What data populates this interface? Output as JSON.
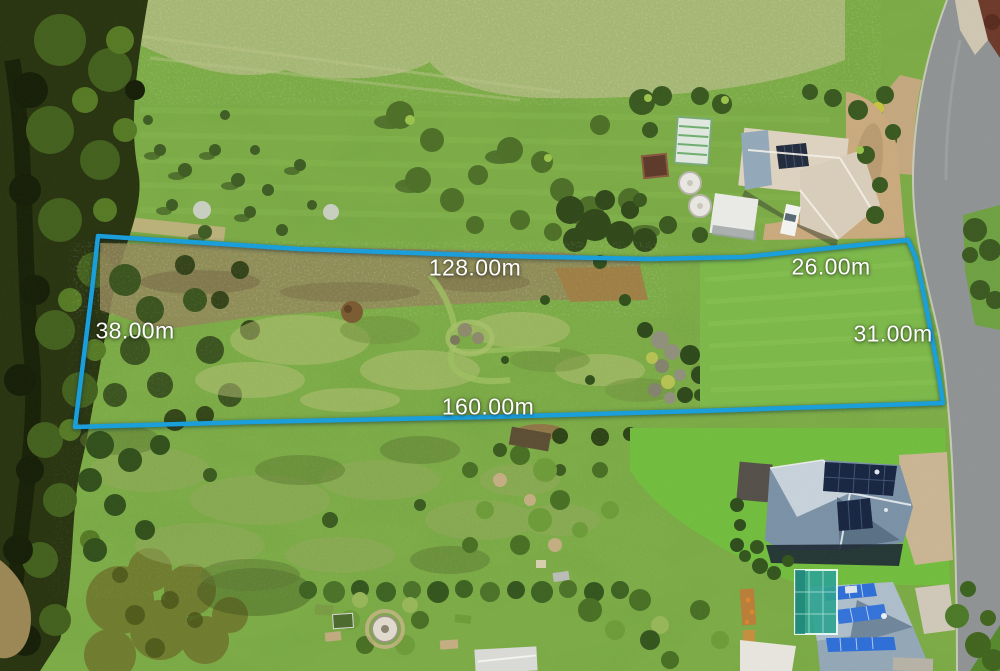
{
  "boundary": {
    "color": "#1b9fdb",
    "labels": {
      "top": "128.00m",
      "top_right": "26.00m",
      "right": "31.00m",
      "bottom": "160.00m",
      "left": "38.00m"
    }
  },
  "palette": {
    "grass_base": "#7cab47",
    "road_asphalt": "#909394",
    "label_text": "#ffffff"
  }
}
